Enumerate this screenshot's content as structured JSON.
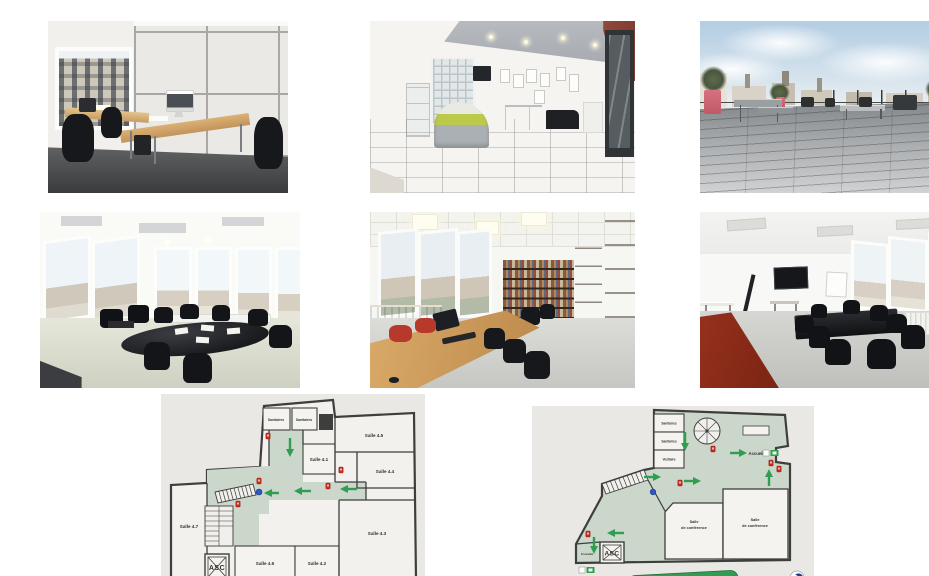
{
  "gallery": {
    "photos": [
      {
        "name": "photo-bureau",
        "alt": "Bureau ferme avec deux postes de travail et ecran iMac"
      },
      {
        "name": "photo-accueil",
        "alt": "Hall d'accueil avec banque verte, pave de verre et porte vitree"
      },
      {
        "name": "photo-terrasse",
        "alt": "Grande terrasse en bois avec vue sur les toits"
      },
      {
        "name": "photo-salle-reunion-angle",
        "alt": "Salle de reunion d'angle avec table ovale noire"
      },
      {
        "name": "photo-salle-travail",
        "alt": "Salle de travail avec grande table en bois et bibliotheque"
      },
      {
        "name": "photo-salle-reunion-ecran",
        "alt": "Salle de reunion avec ecran mural et sol rouge"
      }
    ]
  },
  "plan4": {
    "alt": "Plan d'etage avec salles 4.1 a 4.7",
    "labels": {
      "sanitaires_a": "Sanitaires",
      "sanitaires_b": "Sanitaires",
      "salle_41": "Salle 4.1",
      "salle_45": "Salle 4.5",
      "salle_44": "Salle 4.4",
      "salle_43": "Salle 4.3",
      "salle_42": "Salle 4.2",
      "salle_46": "Salle 4.6",
      "salle_47": "Salle 4.7",
      "ascenseur": "ASC"
    }
  },
  "rdc": {
    "alt": "Plan du rez-de-chaussee avec accueil et salles de conference",
    "banner": "PLAN DU REZ-DE-CHAUSSEE",
    "labels": {
      "sanitaires_a": "Sanitaires",
      "sanitaires_b": "Sanitaires",
      "vestiaire": "Vestiaire",
      "accueil": "Accueil",
      "conf_left_l1": "Salle",
      "conf_left_l2": "de conférence",
      "conf_right_l1": "Salle",
      "conf_right_l2": "de conférence",
      "courette": "Courette",
      "ascenseur": "ASC"
    }
  },
  "colors": {
    "circulation_green": "#cbd7ca",
    "arrow_green": "#2f9e52",
    "safety_red": "#c9281e",
    "banner_green": "#2f9e52",
    "location_blue": "#2e59c4"
  }
}
